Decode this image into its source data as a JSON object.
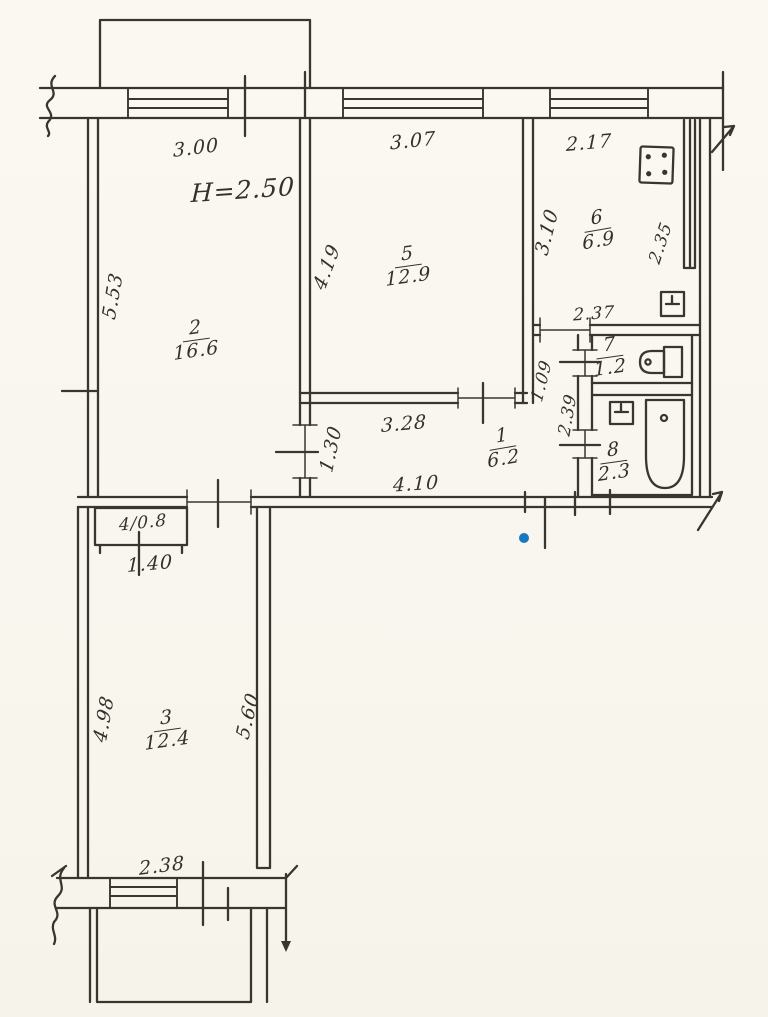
{
  "palette": {
    "ink": "#3a362f",
    "paper": "#f8f6ee",
    "pen_mark_blue": "#1579be"
  },
  "note": {
    "ceiling_height": "H=2.50"
  },
  "rooms": {
    "room1": {
      "number": "1",
      "area": "6.2"
    },
    "room2": {
      "number": "2",
      "area": "16.6"
    },
    "room3": {
      "number": "3",
      "area": "12.4"
    },
    "room5": {
      "number": "5",
      "area": "12.9"
    },
    "room6": {
      "number": "6",
      "area": "6.9"
    },
    "room7": {
      "number": "7",
      "area": "1.2"
    },
    "room8": {
      "number": "8",
      "area": "2.3"
    }
  },
  "closet": {
    "label": "4/0.8"
  },
  "dims": {
    "room2_width_top": "3.00",
    "room5_width_top": "3.07",
    "kitchen_width_top": "2.17",
    "room2_depth_left": "5.53",
    "room5_depth_left": "4.19",
    "kitchen_depth_left": "3.10",
    "shaft_depth": "2.35",
    "kitchen_door": "2.37",
    "passage_width": "1.09",
    "bath_depth": "2.39",
    "room2_door": "1.30",
    "hall_width_top": "3.28",
    "hall_width_bottom": "4.10",
    "closet_width": "1.40",
    "room3_depth_left": "4.98",
    "room3_depth_right": "5.60",
    "room3_window": "2.38"
  },
  "icons": [
    "stove-icon",
    "kitchen-sink-icon",
    "vent-shaft",
    "toilet-icon",
    "washbasin-icon",
    "bathtub-icon",
    "blue-pen-dot"
  ]
}
